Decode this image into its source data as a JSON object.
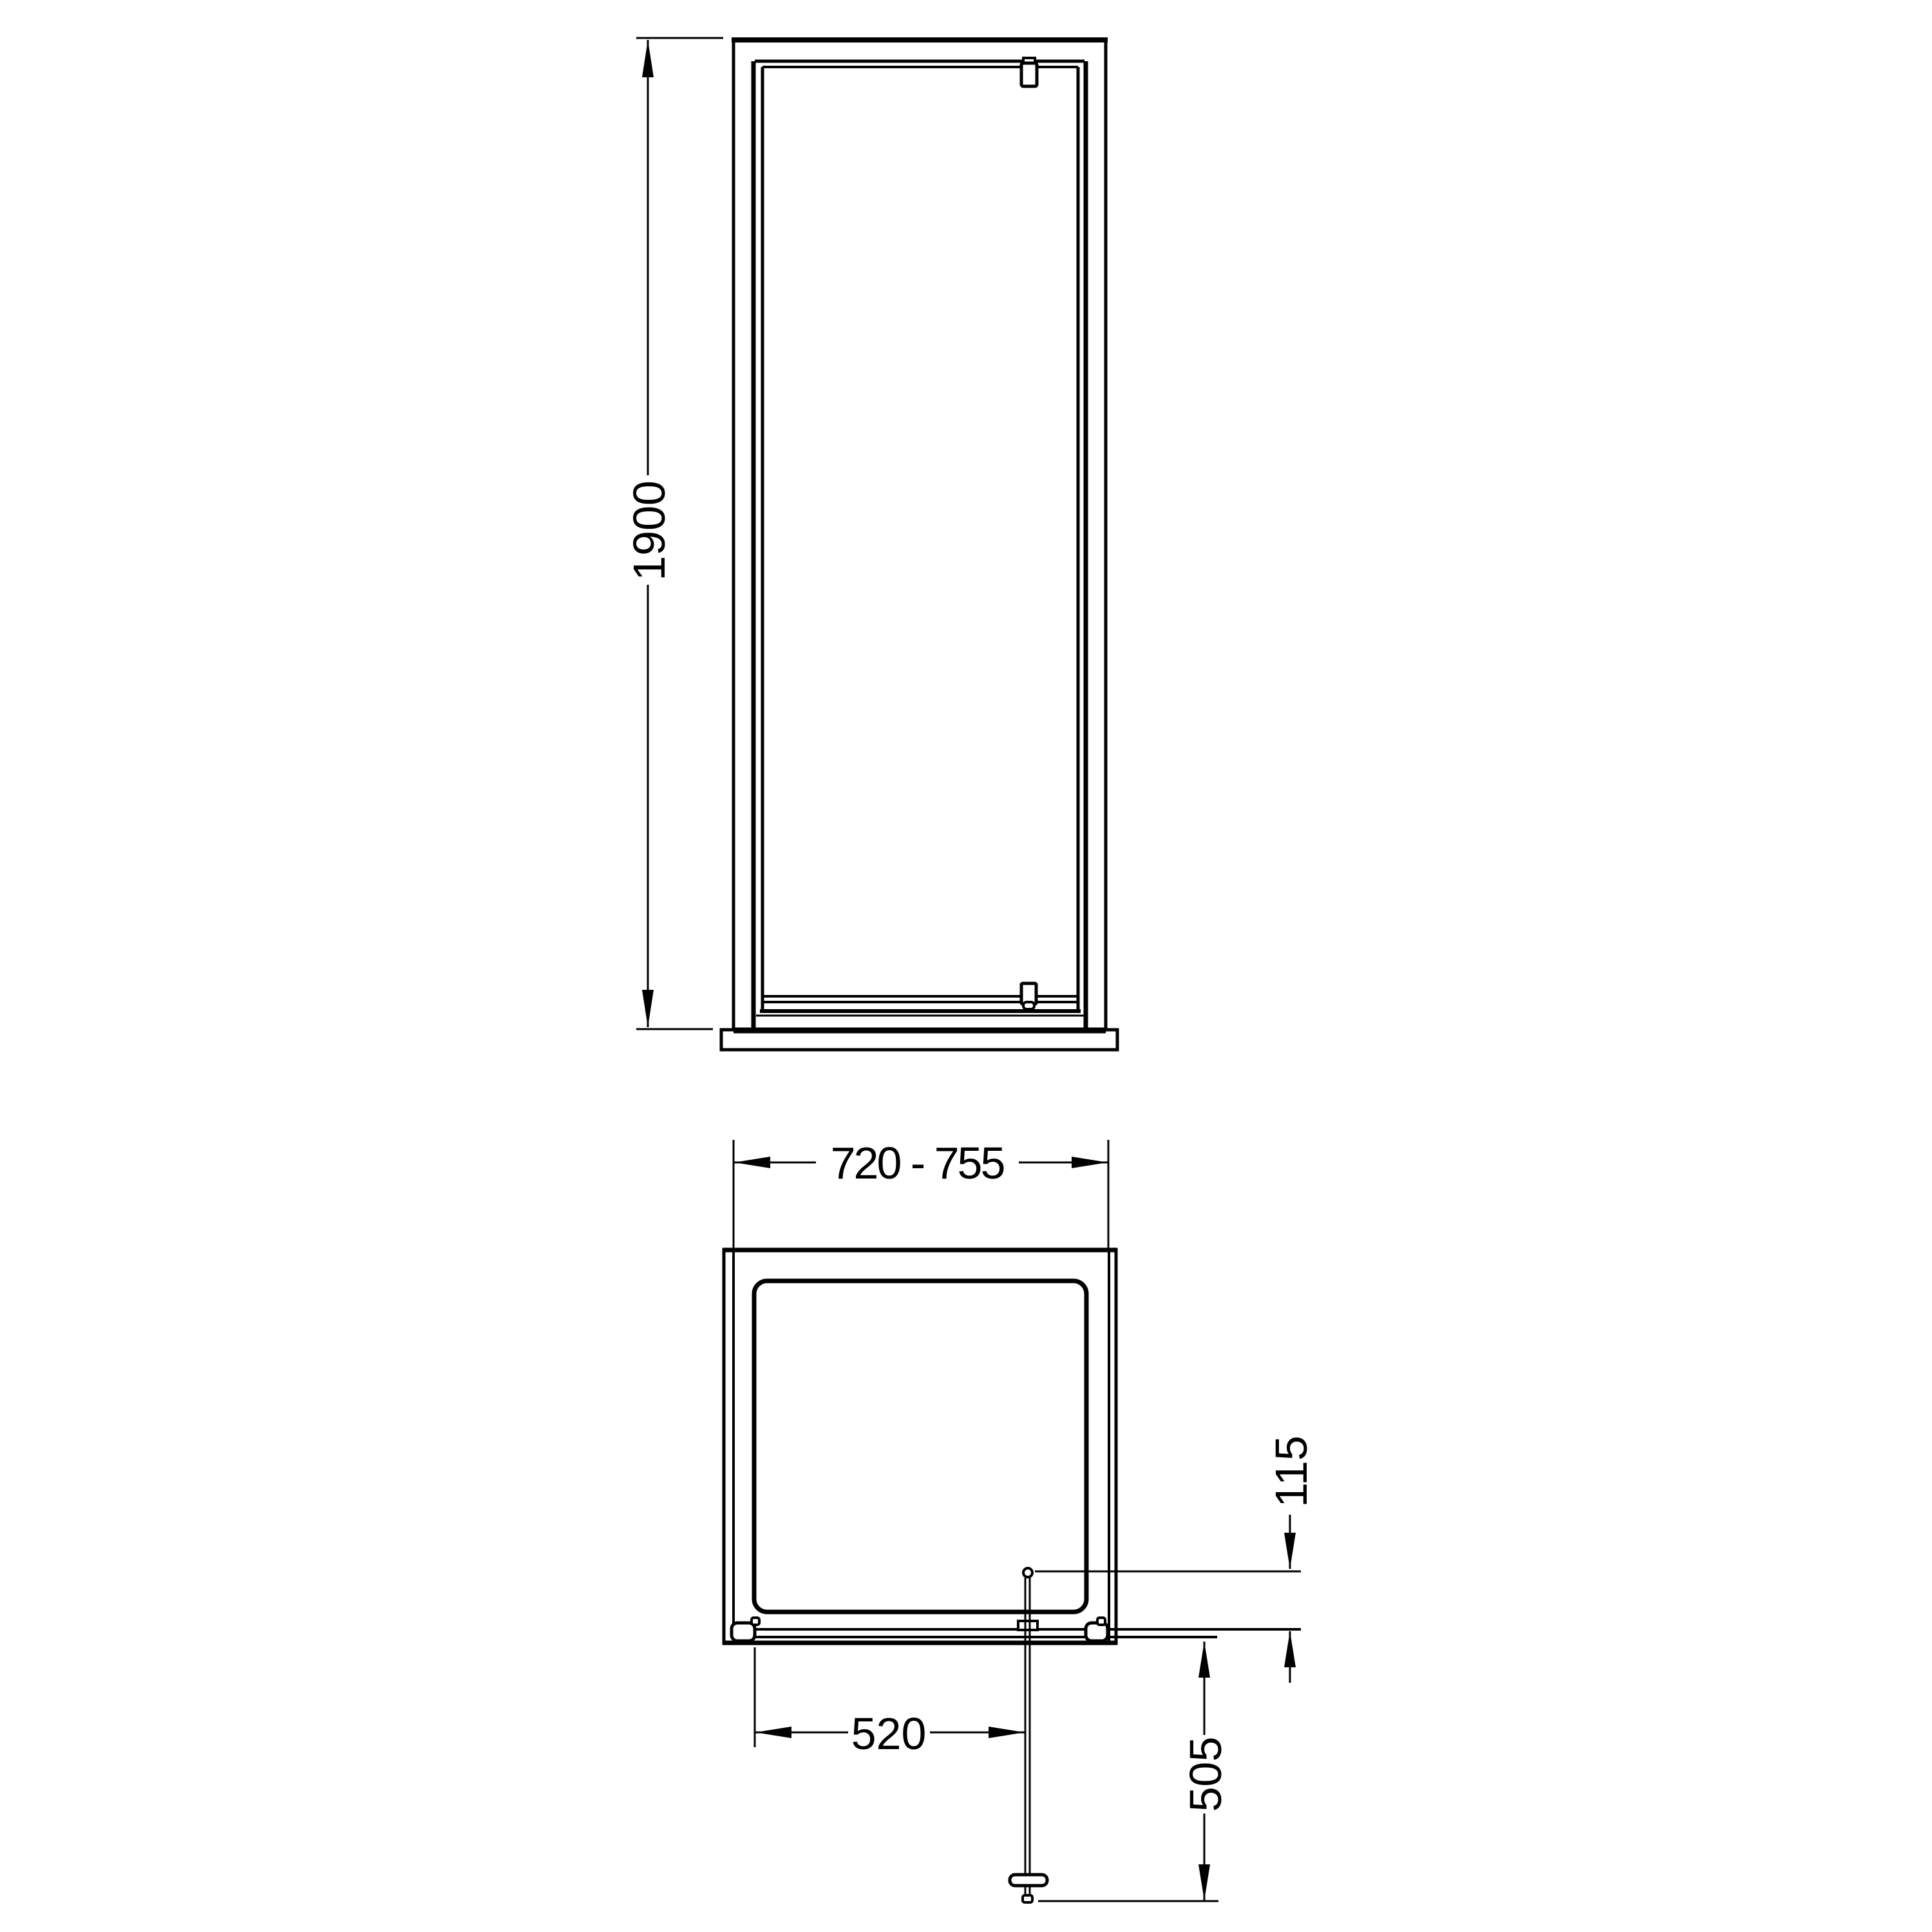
{
  "drawing": {
    "kind": "shower-door-technical-drawing",
    "colors": {
      "line": "#000000",
      "background": "#ffffff"
    },
    "dimensions": {
      "front_height": {
        "value": "1900"
      },
      "width_adjustment": {
        "value": "720 - 755"
      },
      "opening_width": {
        "value": "520"
      },
      "door_projection": {
        "value": "505"
      },
      "pivot_inset": {
        "value": "115"
      }
    }
  }
}
